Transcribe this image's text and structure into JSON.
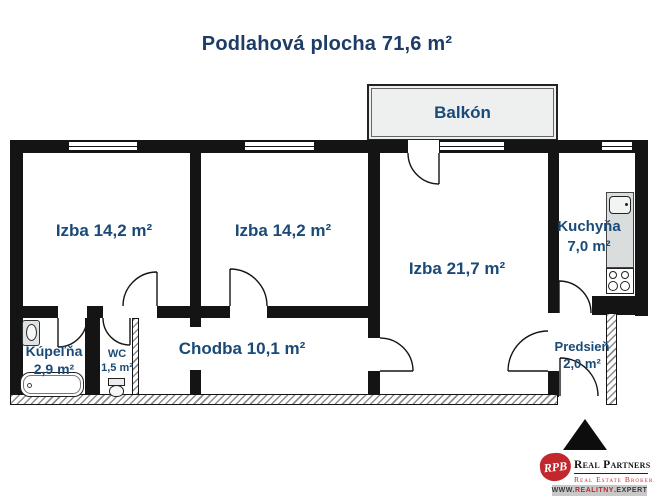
{
  "title": "Podlahová plocha 71,6 m²",
  "colors": {
    "title": "#1d3c66",
    "label": "#1a4a78",
    "wall": "#141414",
    "logo-red": "#c1272d",
    "balcony-fill": "#edf0ee",
    "counter-fill": "#d9dddd"
  },
  "rooms": {
    "balkon": {
      "name": "Balkón"
    },
    "izba1": {
      "name": "Izba 14,2 m²"
    },
    "izba2": {
      "name": "Izba 14,2 m²"
    },
    "izba3": {
      "name": "Izba 21,7 m²"
    },
    "kuchyna": {
      "name": "Kuchyňa",
      "area": "7,0 m²"
    },
    "kupelna": {
      "name": "Kúpeľňa",
      "area": "2,9 m²"
    },
    "wc": {
      "name": "WC",
      "area": "1,5 m²"
    },
    "chodba": {
      "name": "Chodba 10,1 m²"
    },
    "predsien": {
      "name": "Predsieň",
      "area": "2,0 m²"
    }
  },
  "logo": {
    "monogram": "RPB",
    "brand": "Real Partners",
    "tagline": "Real Estate Brokerage",
    "url_www": "WWW.",
    "url_name": "REALITNY",
    "url_tld": ".EXPERT"
  }
}
